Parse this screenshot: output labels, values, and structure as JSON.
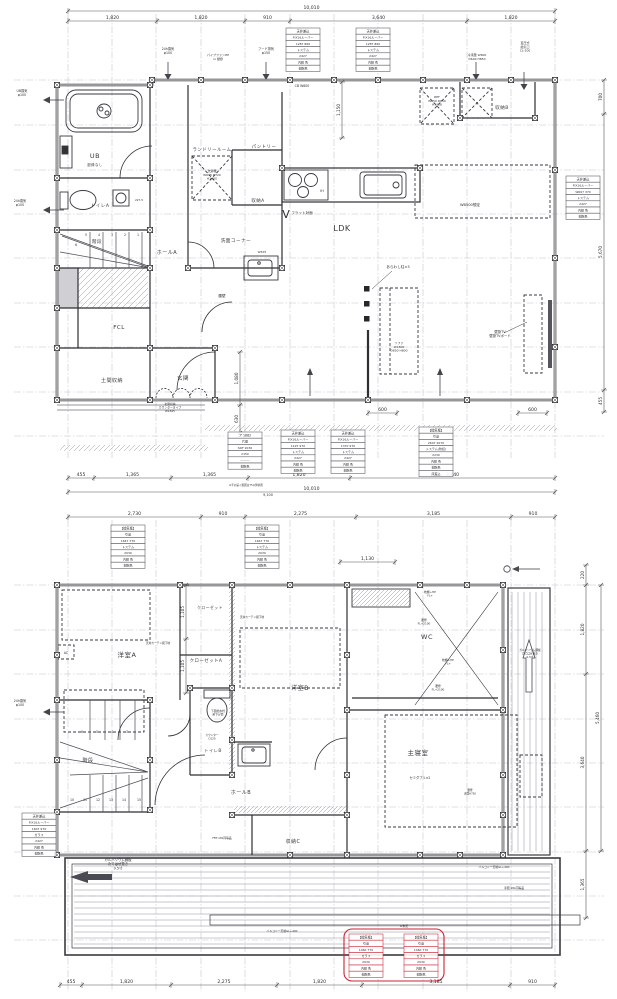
{
  "floor1": {
    "rooms": {
      "ub": "UB",
      "ub_note": "廻縁なし",
      "toilet": "トイレA",
      "stairs": "階段",
      "hall": "ホールA",
      "senmen": "洗面コーナー",
      "laundry": "ランドリールーム",
      "pantry": "パントリー",
      "storage_a": "収納A",
      "storage_b": "収納B",
      "fcl": "FCL",
      "doma": "土間収納",
      "genkan": "玄関",
      "ldk": "LDK"
    },
    "annotations": {
      "ub_vent": "UB換気\nφ100",
      "vent24_a": "24h換気\nφ100",
      "vent24_top": "24h換気\nφ100",
      "pipefan": "パイプファンHP\nor 壁掛",
      "hood": "フード排気\nφ150",
      "cb": "CB W600",
      "freezer": "冷凍庫 W600\nD600 H850",
      "kyuki": "直圧式\n給気口\nCL-200",
      "w675": "W675",
      "washer": "洗濯機\nW645 D720\nH1000",
      "ref": "REF\nW650 D650\nH1828",
      "flat": "フラット対面",
      "ih": "IH",
      "wb500": "WB500想定",
      "araw": "あらわし柱×3",
      "tv": "壁掛TV\n壁掛TVボード",
      "sofa": "ソファ\nW1800\nD850 H800",
      "koshikabe": "腰壁",
      "genkan_shuno": "玄関収納\nカウンタータイプ\nW1645",
      "note75": "※手の届く範囲は75以降参照",
      "v_mark": "V",
      "total2": "9,100",
      "d227": "227.5"
    },
    "dims": {
      "top_total": [
        "10,010"
      ],
      "top": [
        "1,820",
        "1,820",
        "910",
        "3,640",
        "1,820"
      ],
      "bottom": [
        "455",
        "1,365",
        "1,365",
        "1,820",
        "3,640"
      ],
      "bottom_total": [
        "10,010"
      ],
      "right": [
        "700",
        "5,670",
        "455"
      ],
      "d1150": [
        "1,150"
      ],
      "inner_v": [
        "1,080",
        "630"
      ],
      "d600a": [
        "600"
      ],
      "d600b": [
        "600"
      ]
    },
    "stair_numbers": [
      "6",
      "5",
      "4",
      "3",
      "2",
      "1"
    ]
  },
  "floor2": {
    "rooms": {
      "yoshitsu_a": "洋室A",
      "yoshitsu_b": "洋室B",
      "wc": "WIC",
      "wc2": "WC",
      "stairs": "階段",
      "toilet_b": "トイレB",
      "hall_b": "ホールB",
      "storage_c": "収納C",
      "shinshitsu": "主寝室",
      "closet": "クローゼット",
      "closet_a": "クローゼットA"
    },
    "annotations": {
      "vent24": "24h換気\nφ100",
      "curtain1": "天井カーテン開下地",
      "curtain2": "天井カーテン開下地",
      "ac": "AC",
      "makura1": "枕棚+HP\nFL+",
      "koshi1": "腰壁\nFL+2100",
      "makura2": "枕棚+HP\nFL+",
      "koshi2": "腰壁\nFL+2100",
      "counter": "カウンター\nD120",
      "suisen": "下図給水栓\n吊下げ管",
      "semi": "セミダブル×2",
      "koshi3": "腰壁\n天端H750",
      "galva_r": "ガルバリウム鋼板\nたてはぜ葺き\n0.5寸",
      "galva_b": "ガルバリウム鋼板\nたてはぜ葺き\n0.5寸",
      "gl1": "バルコニー天端GL+400",
      "gl2": "バルコニー天端GL+400",
      "tesuri": "手摺:18L同等品",
      "ffp": "FFP:18L同等品",
      "mitei": "※未定"
    },
    "dims": {
      "top": [
        "2,730",
        "910",
        "2,275",
        "3,185",
        "910"
      ],
      "bottom": [
        "455",
        "1,820",
        "2,275",
        "1,820",
        "3,185",
        "910"
      ],
      "right_inner": [
        "220",
        "1,820",
        "3,640",
        "1,365"
      ],
      "right_outer": [
        "5,460"
      ],
      "closet": [
        "1,105",
        "1,105"
      ],
      "d1130": [
        "1,130"
      ]
    },
    "stair_upper": [
      "6",
      "5",
      "4",
      "3"
    ],
    "stair_lower": [
      "10",
      "11",
      "12",
      "13",
      "14",
      "15"
    ]
  },
  "stamps": {
    "f1_top": [
      "天井差込",
      "FIX16ルーバー",
      "1287 860",
      "トステム",
      "2427",
      "内観 色",
      "樹脂色"
    ],
    "f1_right": [
      "天井差込",
      "FIX16ルーバー",
      "W607 370",
      "トステム",
      "2427",
      "内観 色",
      "樹脂色"
    ],
    "f1_genkan": [
      "ア 1882",
      "片開",
      "SDF 2030",
      "2150",
      "———",
      "樹脂色"
    ],
    "f1_b1": [
      "天井差込",
      "FIX16ルーバー",
      "1197 970",
      "トステム",
      "2427",
      "内観 色",
      "樹脂色"
    ],
    "f1_b2": [
      "天井差込",
      "FIX16ルーバー",
      "1370 970",
      "トステム",
      "2427",
      "内観 色",
      "樹脂色"
    ],
    "f1_kanki": [
      "【換気框】",
      "引違",
      "2607 2070",
      "トステム(防犯)",
      "2230",
      "内観 色",
      "樹脂色",
      "床差込"
    ],
    "f2_top": [
      "【換気框】",
      "引違",
      "1647 770",
      "トステム",
      "2030",
      "内観 色",
      "樹脂色"
    ],
    "f2_left": [
      "天井差込",
      "FIX16ルーバー",
      "1607 970",
      "ガラス",
      "2427",
      "内観 色",
      "樹脂色"
    ],
    "f2_red": [
      "【換気框】",
      "引違",
      "1460 770",
      "ガラス",
      "2030",
      "内観 色",
      "樹脂色"
    ]
  },
  "colors": {
    "line": "#2f2f33",
    "grid": "#c3c3cc",
    "accent_red": "#cc2233"
  }
}
